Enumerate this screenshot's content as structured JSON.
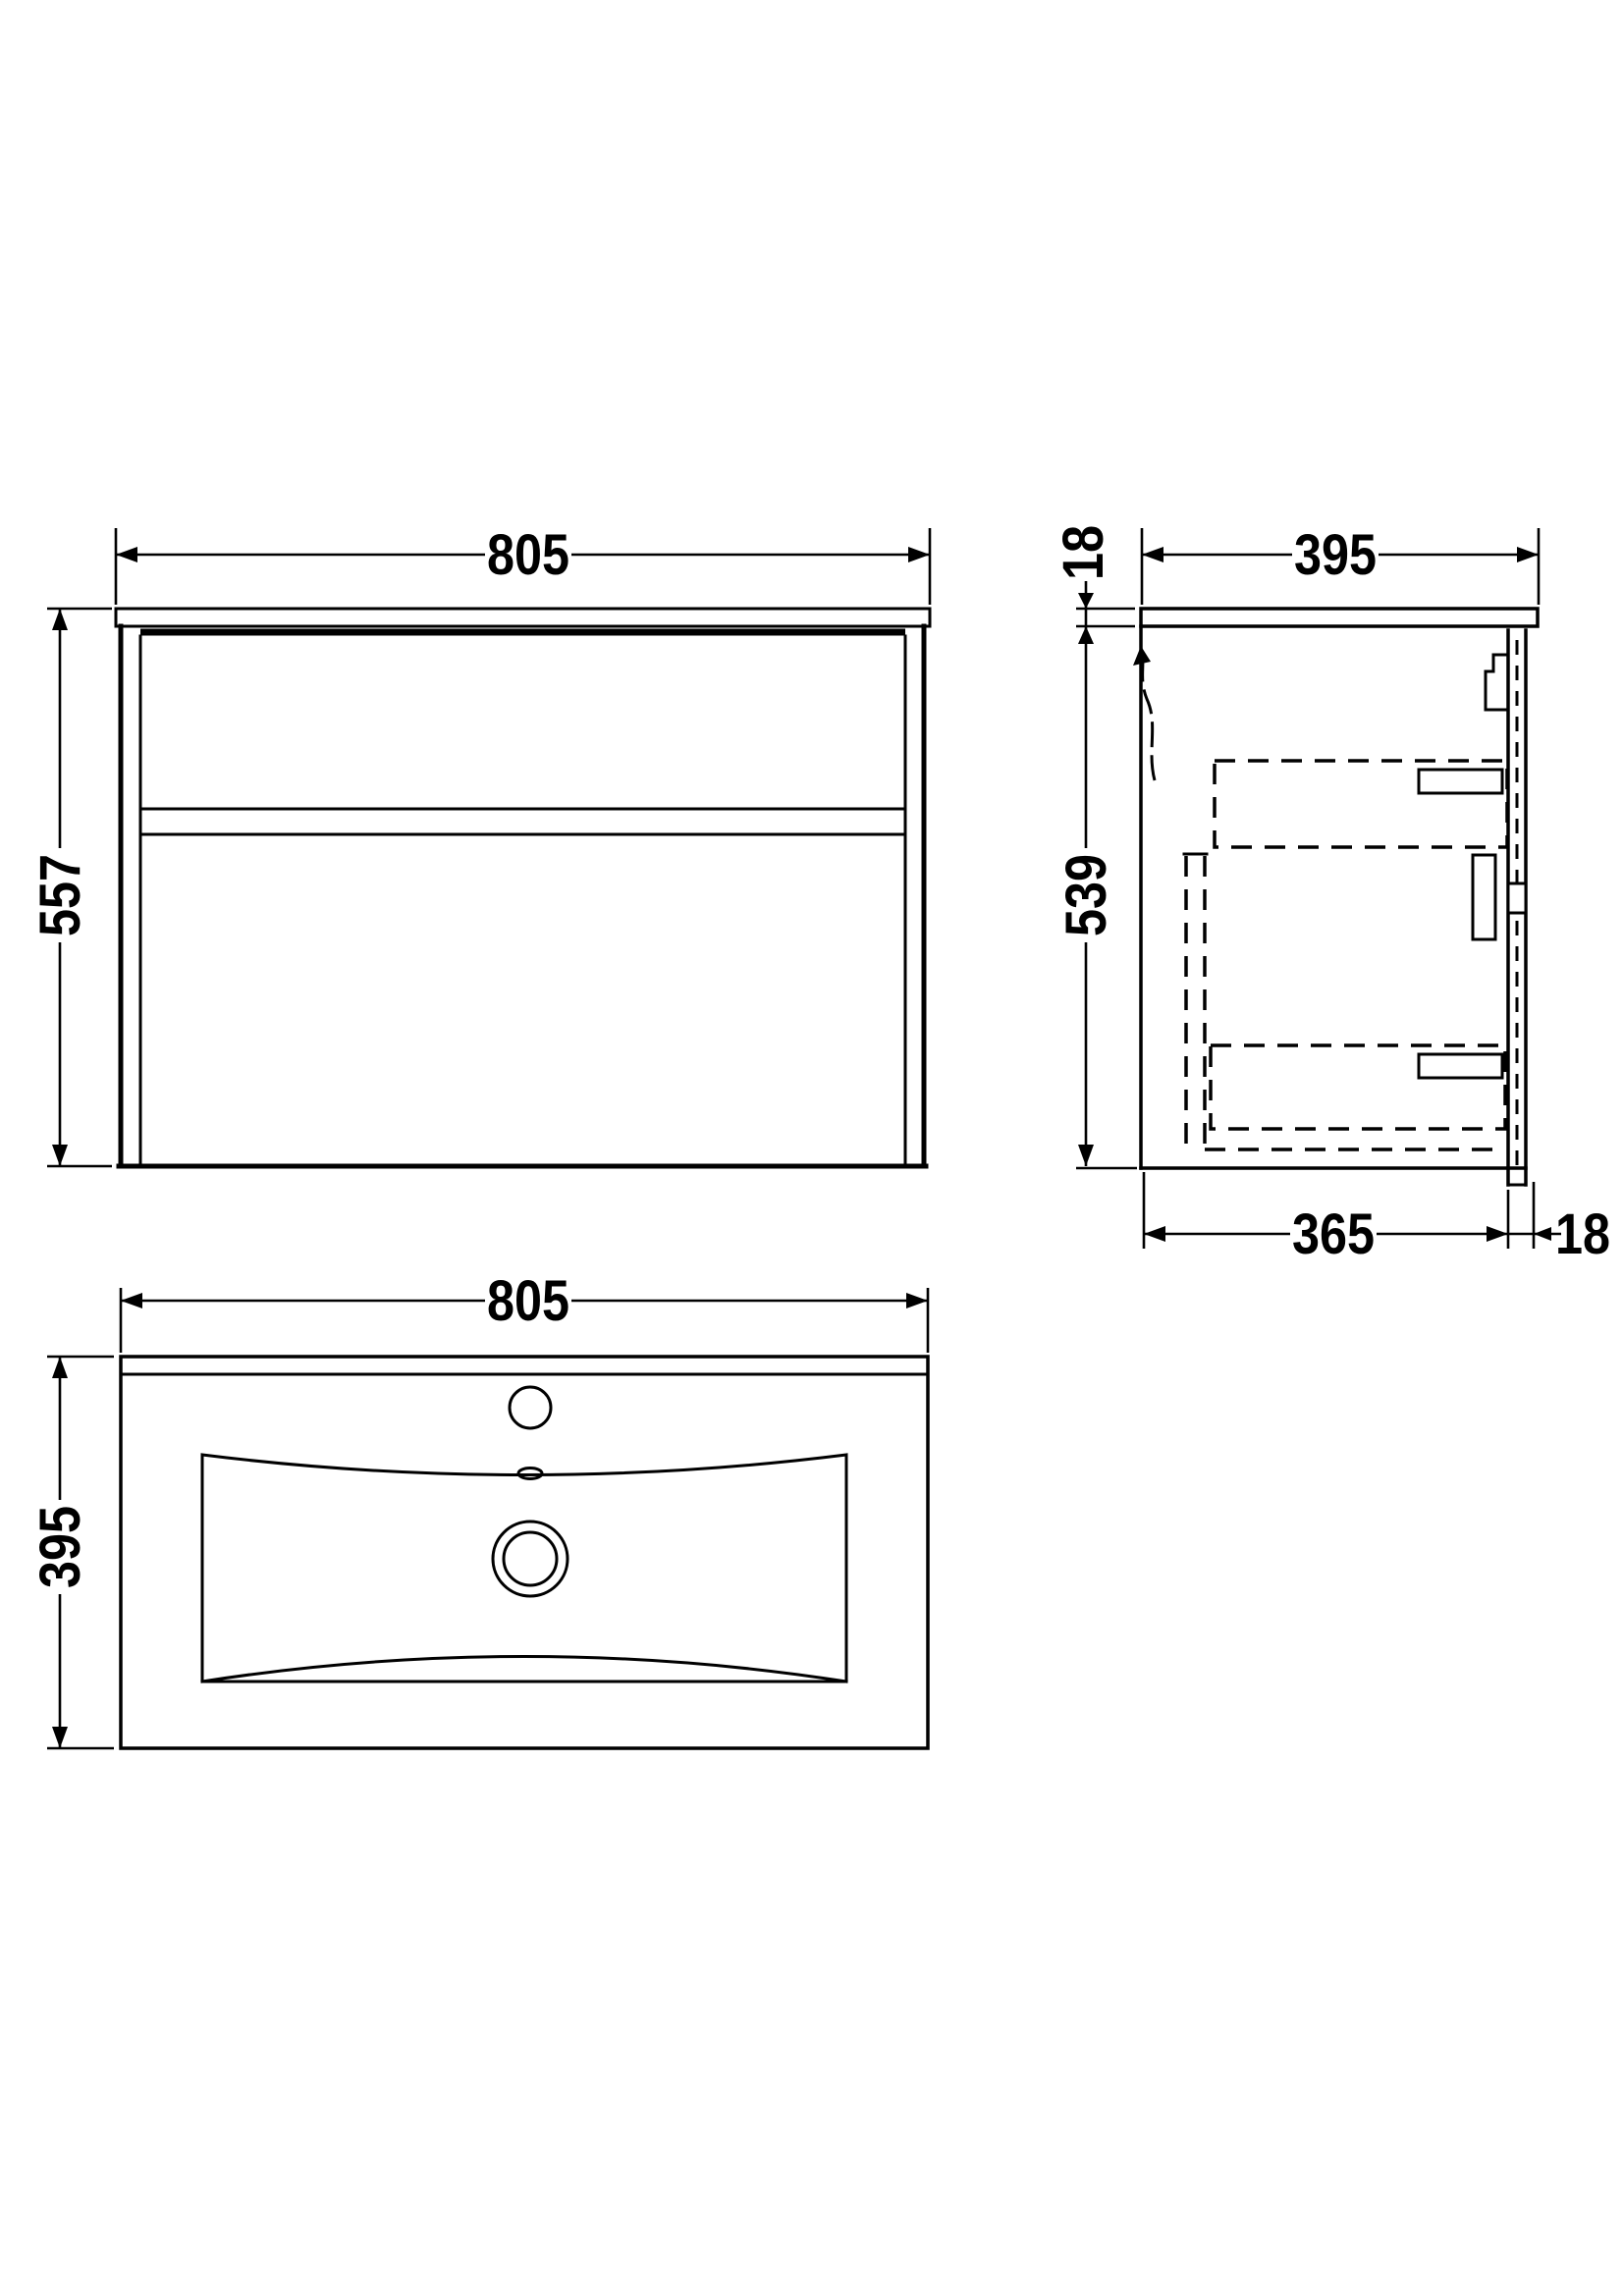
{
  "drawing": {
    "title": "Wall-hung vanity unit with basin - dimensioned drawing",
    "background_color": "#ffffff",
    "line_color": "#000000",
    "units": "mm",
    "views": {
      "front": {
        "name": "front-elevation",
        "width_mm": "805",
        "height_mm": "557"
      },
      "side": {
        "name": "side-section",
        "counter_thickness_mm": "18",
        "depth_mm": "395",
        "carcass_height_mm": "539",
        "carcass_depth_mm": "365",
        "back_gap_mm": "18"
      },
      "plan": {
        "name": "plan-basin-top",
        "width_mm": "805",
        "depth_mm": "395"
      }
    }
  }
}
